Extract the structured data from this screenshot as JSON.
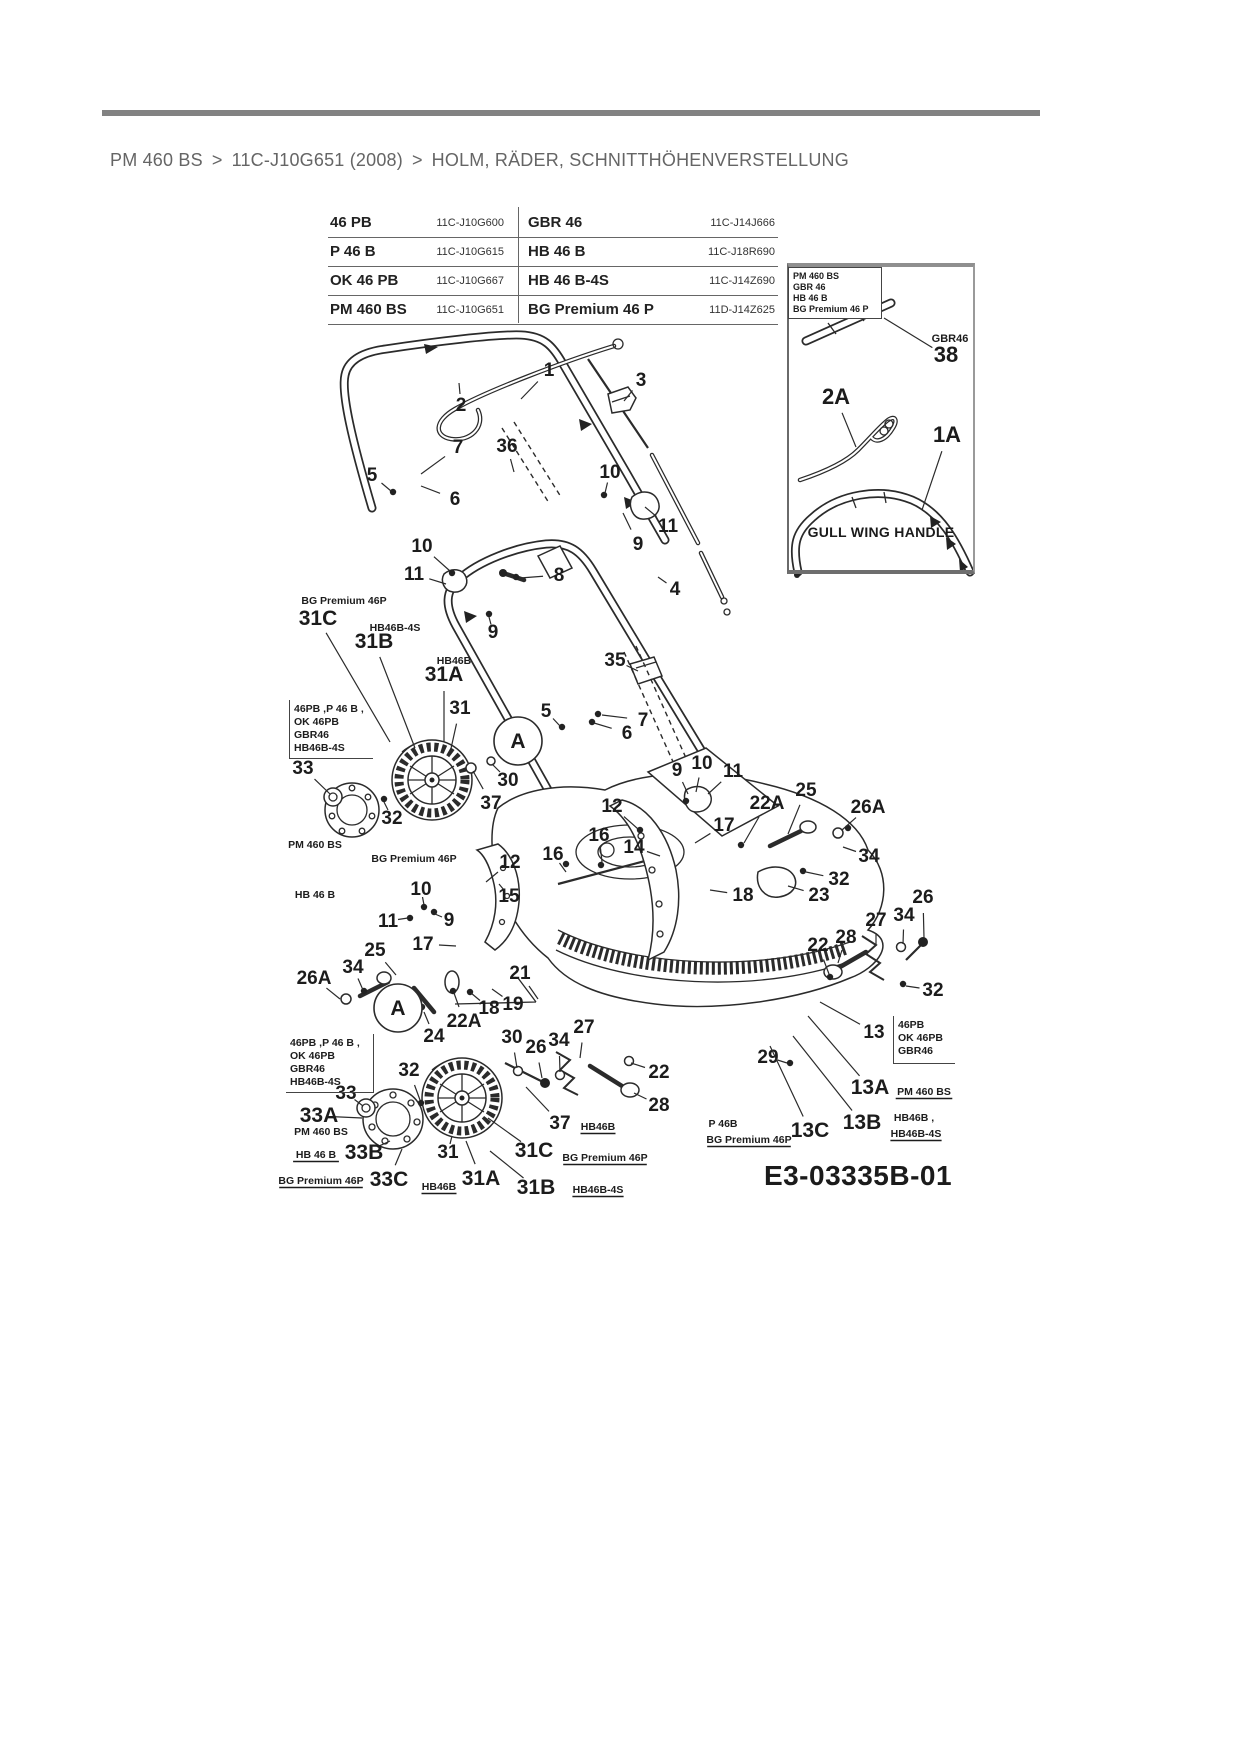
{
  "colors": {
    "ink": "#2b2b2b",
    "rule": "#828282",
    "crumb": "#656565"
  },
  "breadcrumb": {
    "model": "PM 460 BS",
    "separator": ">",
    "variant": "11C-J10G651 (2008)",
    "section": "HOLM, RÄDER, SCHNITTHÖHENVERSTELLUNG"
  },
  "model_table": {
    "rows": [
      {
        "left_model": "46 PB",
        "left_article": "11C-J10G600",
        "right_model": "GBR 46",
        "right_article": "11C-J14J666"
      },
      {
        "left_model": "P 46 B",
        "left_article": "11C-J10G615",
        "right_model": "HB 46 B",
        "right_article": "11C-J18R690"
      },
      {
        "left_model": "OK 46 PB",
        "left_article": "11C-J10G667",
        "right_model": "HB 46 B-4S",
        "right_article": "11C-J14Z690"
      },
      {
        "left_model": "PM 460 BS",
        "left_article": "11C-J10G651",
        "right_model": "BG Premium 46 P",
        "right_article": "11D-J14Z625"
      }
    ]
  },
  "inset": {
    "models": [
      "PM 460 BS",
      "GBR 46",
      "HB 46 B",
      "BG Premium 46 P"
    ],
    "caption": "GULL WING HANDLE",
    "labels": [
      {
        "t": "GBR46",
        "x": 950,
        "y": 342,
        "s": 11
      },
      {
        "t": "38",
        "x": 946,
        "y": 362,
        "s": 22,
        "l": [
          884,
          318
        ]
      },
      {
        "t": "2A",
        "x": 836,
        "y": 404,
        "s": 22,
        "l": [
          856,
          447
        ]
      },
      {
        "t": "1A",
        "x": 947,
        "y": 442,
        "s": 22,
        "l": [
          922,
          510
        ]
      }
    ]
  },
  "diagram": {
    "drawing_number": "E3-03335B-01",
    "a_markers": [
      {
        "x": 518,
        "y": 748,
        "r": 24,
        "label": "A"
      },
      {
        "x": 398,
        "y": 1015,
        "r": 24,
        "label": "A"
      }
    ],
    "callouts": [
      {
        "t": "1",
        "x": 549,
        "y": 376,
        "l": [
          521,
          399
        ]
      },
      {
        "t": "2",
        "x": 461,
        "y": 411,
        "l": [
          459,
          383
        ]
      },
      {
        "t": "3",
        "x": 641,
        "y": 386,
        "l": [
          624,
          401
        ]
      },
      {
        "t": "7",
        "x": 458,
        "y": 453,
        "l": [
          421,
          474
        ]
      },
      {
        "t": "36",
        "x": 507,
        "y": 452,
        "l": [
          514,
          472
        ]
      },
      {
        "t": "5",
        "x": 372,
        "y": 481,
        "l": [
          391,
          491
        ]
      },
      {
        "t": "6",
        "x": 455,
        "y": 505,
        "l": [
          421,
          486
        ]
      },
      {
        "t": "10",
        "x": 610,
        "y": 478,
        "l": [
          605,
          493
        ]
      },
      {
        "t": "11",
        "x": 668,
        "y": 532,
        "l": [
          645,
          507
        ]
      },
      {
        "t": "9",
        "x": 638,
        "y": 550,
        "l": [
          623,
          513
        ]
      },
      {
        "t": "10",
        "x": 422,
        "y": 552,
        "l": [
          450,
          571
        ]
      },
      {
        "t": "11",
        "x": 414,
        "y": 580,
        "l": [
          446,
          584
        ]
      },
      {
        "t": "8",
        "x": 559,
        "y": 581,
        "l": [
          520,
          578
        ]
      },
      {
        "t": "4",
        "x": 675,
        "y": 595,
        "l": [
          658,
          577
        ]
      },
      {
        "t": "35",
        "x": 615,
        "y": 666,
        "l": [
          638,
          671
        ]
      },
      {
        "t": "9",
        "x": 493,
        "y": 638,
        "l": [
          489,
          617
        ]
      },
      {
        "t": "5",
        "x": 546,
        "y": 717,
        "l": [
          560,
          726
        ]
      },
      {
        "t": "7",
        "x": 643,
        "y": 726,
        "l": [
          602,
          715
        ]
      },
      {
        "t": "6",
        "x": 627,
        "y": 739,
        "l": [
          594,
          723
        ]
      },
      {
        "t": "31C",
        "x": 318,
        "y": 625,
        "s": 21,
        "l": [
          390,
          742
        ]
      },
      {
        "t": "31B",
        "x": 374,
        "y": 648,
        "s": 21,
        "l": [
          415,
          748
        ]
      },
      {
        "t": "31A",
        "x": 444,
        "y": 681,
        "s": 21,
        "l": [
          444,
          742
        ]
      },
      {
        "t": "31",
        "x": 460,
        "y": 714,
        "l": [
          450,
          753
        ]
      },
      {
        "t": "33",
        "x": 303,
        "y": 774,
        "l": [
          330,
          794
        ]
      },
      {
        "t": "32",
        "x": 392,
        "y": 824,
        "l": [
          384,
          802
        ]
      },
      {
        "t": "30",
        "x": 508,
        "y": 786,
        "l": [
          492,
          764
        ]
      },
      {
        "t": "37",
        "x": 491,
        "y": 809,
        "l": [
          473,
          771
        ]
      },
      {
        "t": "12",
        "x": 612,
        "y": 812,
        "l": [
          638,
          829
        ]
      },
      {
        "t": "9",
        "x": 677,
        "y": 776,
        "l": [
          688,
          794
        ]
      },
      {
        "t": "10",
        "x": 702,
        "y": 769,
        "l": [
          696,
          792
        ]
      },
      {
        "t": "11",
        "x": 733,
        "y": 777,
        "l": [
          708,
          794
        ]
      },
      {
        "t": "16",
        "x": 599,
        "y": 841,
        "l": [
          602,
          862
        ]
      },
      {
        "t": "14",
        "x": 634,
        "y": 853,
        "l": [
          660,
          856
        ]
      },
      {
        "t": "17",
        "x": 724,
        "y": 831,
        "l": [
          695,
          843
        ]
      },
      {
        "t": "22A",
        "x": 767,
        "y": 809,
        "l": [
          744,
          843
        ]
      },
      {
        "t": "25",
        "x": 806,
        "y": 796,
        "l": [
          788,
          834
        ]
      },
      {
        "t": "26A",
        "x": 868,
        "y": 813,
        "l": [
          842,
          830
        ]
      },
      {
        "t": "34",
        "x": 869,
        "y": 862,
        "l": [
          843,
          847
        ]
      },
      {
        "t": "32",
        "x": 839,
        "y": 885,
        "l": [
          806,
          872
        ]
      },
      {
        "t": "23",
        "x": 819,
        "y": 901,
        "l": [
          788,
          886
        ]
      },
      {
        "t": "18",
        "x": 743,
        "y": 901,
        "l": [
          710,
          890
        ]
      },
      {
        "t": "26",
        "x": 923,
        "y": 903,
        "l": [
          924,
          938
        ]
      },
      {
        "t": "34",
        "x": 904,
        "y": 921,
        "l": [
          903,
          944
        ]
      },
      {
        "t": "27",
        "x": 876,
        "y": 926,
        "l": [
          876,
          946
        ]
      },
      {
        "t": "28",
        "x": 846,
        "y": 943,
        "l": [
          838,
          963
        ]
      },
      {
        "t": "22",
        "x": 818,
        "y": 951,
        "l": [
          829,
          974
        ]
      },
      {
        "t": "32",
        "x": 933,
        "y": 996,
        "l": [
          906,
          986
        ]
      },
      {
        "t": "13",
        "x": 874,
        "y": 1038,
        "l": [
          820,
          1002
        ]
      },
      {
        "t": "29",
        "x": 768,
        "y": 1063,
        "l": [
          787,
          1063
        ]
      },
      {
        "t": "13A",
        "x": 870,
        "y": 1094,
        "s": 21,
        "l": [
          808,
          1016
        ]
      },
      {
        "t": "13B",
        "x": 862,
        "y": 1129,
        "s": 21,
        "l": [
          793,
          1036
        ]
      },
      {
        "t": "13C",
        "x": 810,
        "y": 1137,
        "s": 21,
        "l": [
          770,
          1046
        ]
      },
      {
        "t": "12",
        "x": 510,
        "y": 868,
        "l": [
          486,
          882
        ]
      },
      {
        "t": "16",
        "x": 553,
        "y": 860,
        "l": [
          566,
          872
        ]
      },
      {
        "t": "15",
        "x": 509,
        "y": 902,
        "l": [
          499,
          884
        ]
      },
      {
        "t": "10",
        "x": 421,
        "y": 895,
        "l": [
          424,
          905
        ]
      },
      {
        "t": "11",
        "x": 388,
        "y": 927,
        "l": [
          408,
          918
        ]
      },
      {
        "t": "9",
        "x": 449,
        "y": 926,
        "l": [
          435,
          914
        ]
      },
      {
        "t": "17",
        "x": 423,
        "y": 950,
        "l": [
          456,
          946
        ]
      },
      {
        "t": "25",
        "x": 375,
        "y": 956,
        "l": [
          396,
          975
        ]
      },
      {
        "t": "34",
        "x": 353,
        "y": 973,
        "l": [
          363,
          990
        ]
      },
      {
        "t": "26A",
        "x": 314,
        "y": 984,
        "l": [
          340,
          999
        ]
      },
      {
        "t": "21",
        "x": 520,
        "y": 979,
        "l": [
          538,
          999
        ]
      },
      {
        "t": "19",
        "x": 513,
        "y": 1010,
        "l": [
          492,
          989
        ]
      },
      {
        "t": "18",
        "x": 489,
        "y": 1014,
        "l": [
          471,
          993
        ]
      },
      {
        "t": "22A",
        "x": 464,
        "y": 1027,
        "l": [
          454,
          993
        ]
      },
      {
        "t": "24",
        "x": 434,
        "y": 1042,
        "l": [
          424,
          1012
        ]
      },
      {
        "t": "30",
        "x": 512,
        "y": 1043,
        "l": [
          517,
          1068
        ]
      },
      {
        "t": "26",
        "x": 536,
        "y": 1053,
        "l": [
          542,
          1078
        ]
      },
      {
        "t": "34",
        "x": 559,
        "y": 1046,
        "l": [
          560,
          1072
        ]
      },
      {
        "t": "27",
        "x": 584,
        "y": 1033,
        "l": [
          580,
          1058
        ]
      },
      {
        "t": "22",
        "x": 659,
        "y": 1078,
        "l": [
          631,
          1063
        ]
      },
      {
        "t": "28",
        "x": 659,
        "y": 1111,
        "l": [
          634,
          1093
        ]
      },
      {
        "t": "32",
        "x": 409,
        "y": 1076,
        "l": [
          420,
          1100
        ]
      },
      {
        "t": "33",
        "x": 346,
        "y": 1099,
        "l": [
          363,
          1106
        ]
      },
      {
        "t": "33A",
        "x": 319,
        "y": 1122,
        "s": 21,
        "l": [
          362,
          1118
        ]
      },
      {
        "t": "33B",
        "x": 364,
        "y": 1159,
        "s": 21,
        "l": [
          390,
          1141
        ]
      },
      {
        "t": "33C",
        "x": 389,
        "y": 1186,
        "s": 21,
        "l": [
          402,
          1149
        ]
      },
      {
        "t": "31",
        "x": 448,
        "y": 1158,
        "l": [
          452,
          1136
        ]
      },
      {
        "t": "31C",
        "x": 534,
        "y": 1157,
        "s": 21,
        "l": [
          488,
          1118
        ]
      },
      {
        "t": "31A",
        "x": 481,
        "y": 1185,
        "s": 21,
        "l": [
          466,
          1141
        ]
      },
      {
        "t": "31B",
        "x": 536,
        "y": 1194,
        "s": 21,
        "l": [
          490,
          1151
        ]
      },
      {
        "t": "37",
        "x": 560,
        "y": 1129,
        "l": [
          526,
          1087
        ]
      }
    ],
    "sub_labels": [
      {
        "t": "BG Premium 46P",
        "x": 344,
        "y": 604
      },
      {
        "t": "HB46B-4S",
        "x": 395,
        "y": 631
      },
      {
        "t": "HB46B",
        "x": 454,
        "y": 664
      },
      {
        "t": "PM 460 BS",
        "x": 315,
        "y": 848
      },
      {
        "t": "HB 46 B",
        "x": 315,
        "y": 898
      },
      {
        "t": "BG Premium 46P",
        "x": 414,
        "y": 862
      },
      {
        "t": "PM 460 BS",
        "x": 321,
        "y": 1135
      },
      {
        "t": "HB 46 B",
        "x": 316,
        "y": 1158,
        "u": 1
      },
      {
        "t": "BG Premium 46P",
        "x": 321,
        "y": 1184,
        "u": 1
      },
      {
        "t": "HB46B",
        "x": 439,
        "y": 1190,
        "u": 1
      },
      {
        "t": "HB46B-4S",
        "x": 598,
        "y": 1193,
        "u": 1
      },
      {
        "t": "BG Premium 46P",
        "x": 605,
        "y": 1161,
        "u": 1
      },
      {
        "t": "HB46B",
        "x": 598,
        "y": 1130,
        "u": 1
      },
      {
        "t": "PM 460 BS",
        "x": 924,
        "y": 1095,
        "u": 1
      },
      {
        "t": "HB46B ,",
        "x": 914,
        "y": 1121
      },
      {
        "t": "HB46B-4S",
        "x": 916,
        "y": 1137,
        "u": 1
      },
      {
        "t": "P 46B",
        "x": 723,
        "y": 1127
      },
      {
        "t": "BG Premium 46P",
        "x": 749,
        "y": 1143,
        "u": 1
      }
    ],
    "model_boxes": [
      {
        "x": 289,
        "y": 700,
        "w": 84,
        "h": 58,
        "border": "lb",
        "lines": [
          "46PB ,P 46 B ,",
          "OK 46PB",
          "GBR46",
          "HB46B-4S"
        ]
      },
      {
        "x": 286,
        "y": 1034,
        "w": 88,
        "h": 58,
        "border": "rb",
        "lines": [
          "46PB ,P 46 B ,",
          "OK 46PB",
          "GBR46",
          "HB46B-4S"
        ]
      },
      {
        "x": 893,
        "y": 1016,
        "w": 62,
        "h": 48,
        "border": "lb",
        "lines": [
          "46PB",
          "OK 46PB",
          "GBR46"
        ]
      }
    ]
  }
}
